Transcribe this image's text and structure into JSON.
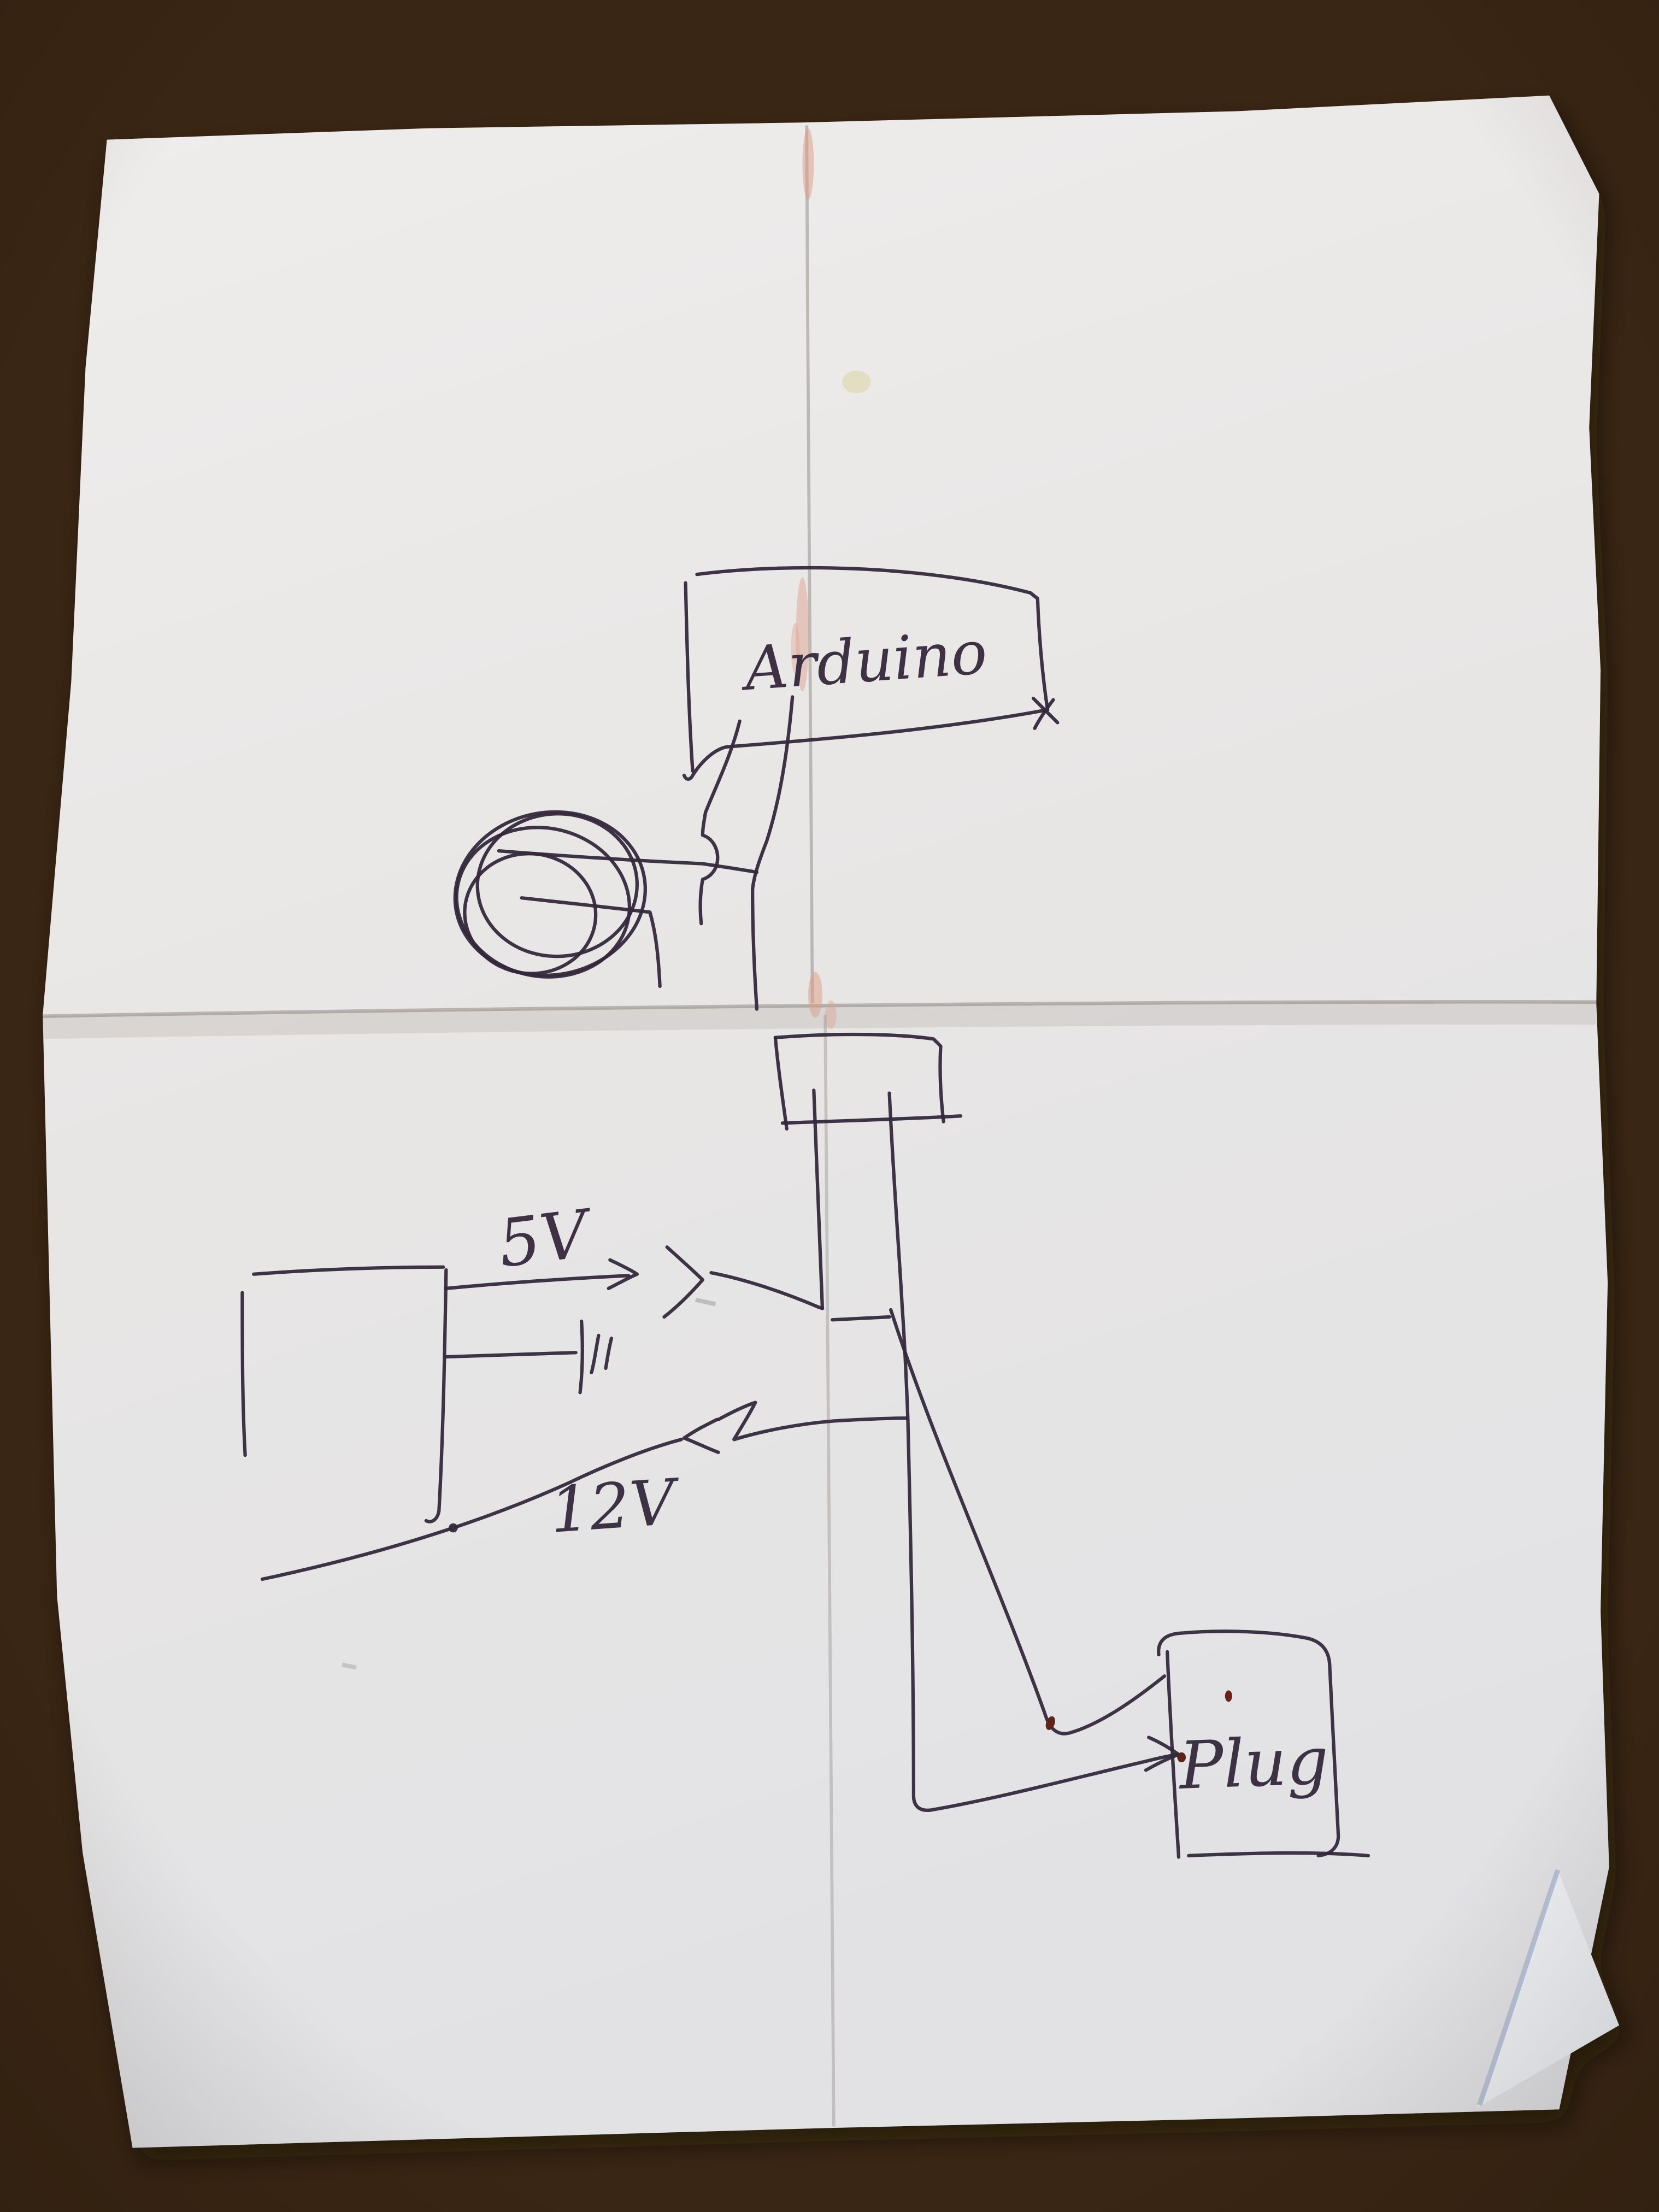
{
  "scene": {
    "description": "Photo of a hand-drawn circuit sketch in dark pen on a creased sheet of paper lying on a wooden table",
    "paper": "folded white paper, horizontal center crease and vertical crease, folded corner bottom-right",
    "surface": "wood table with diagonal grain streaks"
  },
  "labels": {
    "arduino": "Arduino",
    "v5": "5V",
    "v12": "12V",
    "plug": "Plug"
  },
  "components": [
    {
      "name": "arduino-box",
      "label": "Arduino",
      "position": "top center"
    },
    {
      "name": "coil-scribble",
      "label": "",
      "position": "left of arduino leads, scribbled circle"
    },
    {
      "name": "connector-box",
      "label": "",
      "position": "middle, small unlabeled rectangle"
    },
    {
      "name": "power-supply-box",
      "label": "",
      "position": "middle left, open rectangle with output rail"
    },
    {
      "name": "capacitor-symbol",
      "label": "",
      "position": "on middle wire from power supply rail"
    },
    {
      "name": "plug-box",
      "label": "Plug",
      "position": "bottom right rounded rectangle"
    }
  ],
  "connections": [
    {
      "from": "arduino-box",
      "to": "coil-scribble",
      "note": "two leads, left lead has hop-over bump"
    },
    {
      "from": "arduino-box",
      "to": "connector-box",
      "note": "right lead continues down across fold"
    },
    {
      "from": "power-supply-box",
      "to": "connector-box",
      "note": "5V wire with right-pointing arrow labeled 5V"
    },
    {
      "from": "power-supply-box",
      "to": "capacitor-symbol",
      "note": "middle stub wire ending in capacitor bars"
    },
    {
      "from": "power-supply-box",
      "to": "plug-box",
      "note": "12V return wire with left-pointing arrow labeled 12V, runs down then right into Plug with arrow"
    },
    {
      "from": "connector-box",
      "to": "plug-box",
      "note": "slanted wire descending to upper-left of Plug"
    }
  ],
  "colors": {
    "ink": "#35283c",
    "ink_blob_red": "#5f2418",
    "paper": "#e9e7e6",
    "crease_pink": "#dd9c85",
    "stain_yellow": "#ddd3a2",
    "wood_dark": "#64421f",
    "wood_mid": "#74502a",
    "wood_light": "#957041"
  }
}
